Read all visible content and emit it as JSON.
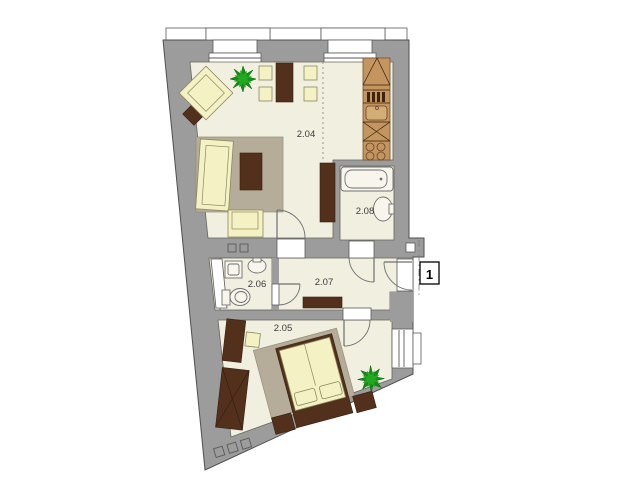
{
  "floor_plan": {
    "type": "apartment-floor-plan",
    "rooms": [
      {
        "label": "2.04",
        "name": "living-room-with-kitchen"
      },
      {
        "label": "2.05",
        "name": "bedroom"
      },
      {
        "label": "2.06",
        "name": "wc-bathroom-small"
      },
      {
        "label": "2.07",
        "name": "hallway"
      },
      {
        "label": "2.08",
        "name": "bathroom"
      }
    ],
    "entrance": {
      "label": "1"
    },
    "colors": {
      "wall": "#9c9c9c",
      "floor": "#f1efdf",
      "furniture_light": "#f4f1c4",
      "furniture_dark": "#53301c",
      "rug": "#b5ad99",
      "kitchen_wood": "#c4955e",
      "plant_green": "#149114",
      "background": "#ffffff"
    }
  }
}
